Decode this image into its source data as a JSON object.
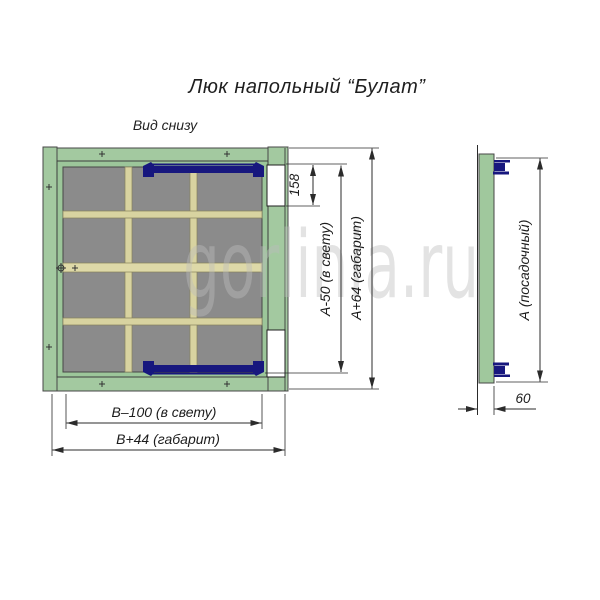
{
  "title": "Люк напольный “Булат”",
  "view_label": "Вид снизу",
  "watermark": "gorlinia.ru",
  "main_view": {
    "dimensions": {
      "hinge_offset": "158",
      "height_clear": "А-50 (в свету)",
      "height_overall": "А+64 (габарит)",
      "width_clear": "В–100 (в свету)",
      "width_overall": "В+44 (габарит)"
    }
  },
  "side_view": {
    "dimensions": {
      "seat_height": "А (посадочный)",
      "depth": "60"
    }
  },
  "colors": {
    "frame_green": "#a3c9a0",
    "lid_green": "#9cc69a",
    "panel_gray": "#8b8b8b",
    "rib_beige": "#d8d3a0",
    "latch_navy": "#17177e",
    "hinge_white": "#ffffff",
    "dimension_line": "#2b2b2b",
    "watermark_gray": "#bdbdbd"
  }
}
